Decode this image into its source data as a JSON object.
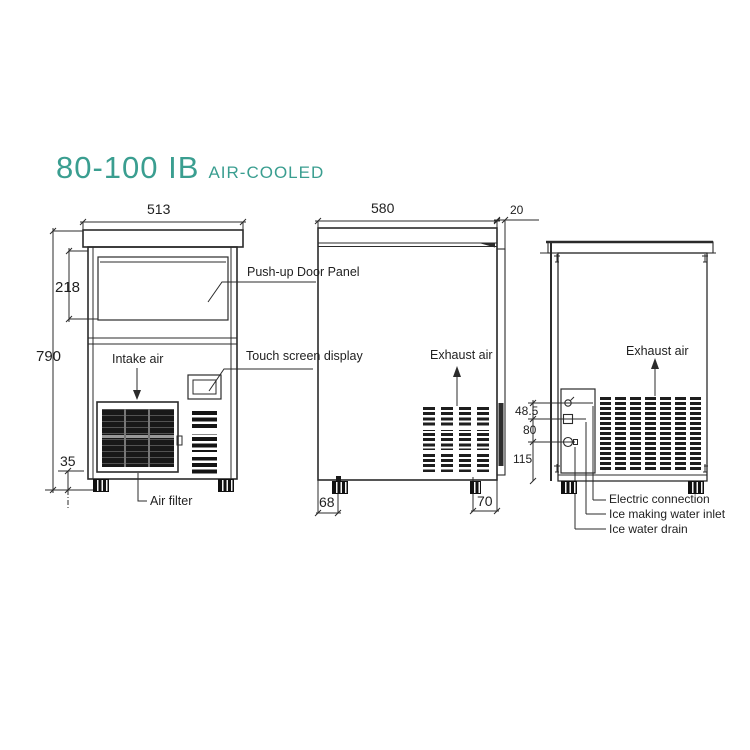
{
  "title": {
    "model": "80-100 IB",
    "variant": "AIR-COOLED",
    "accent_color": "#3a9e90"
  },
  "front_view": {
    "dims": {
      "width": "513",
      "door_height": "218",
      "total_height": "790",
      "foot_height": "35"
    },
    "labels": {
      "push_up_door": "Push-up Door Panel",
      "touch_screen": "Touch screen display",
      "intake_air": "Intake air",
      "air_filter": "Air filter"
    }
  },
  "side_view": {
    "dims": {
      "depth": "580",
      "rear_panel": "20",
      "front_foot_offset": "68",
      "rear_foot_offset": "70"
    },
    "labels": {
      "exhaust_air": "Exhaust air"
    }
  },
  "back_view": {
    "dims": {
      "electric_offset": "48.5",
      "inlet_offset": "80",
      "drain_offset": "115"
    },
    "labels": {
      "exhaust_air": "Exhaust air",
      "electric_connection": "Electric connection",
      "water_inlet": "Ice making water inlet",
      "water_drain": "Ice water drain"
    }
  },
  "colors": {
    "line": "#2b2b2b"
  }
}
